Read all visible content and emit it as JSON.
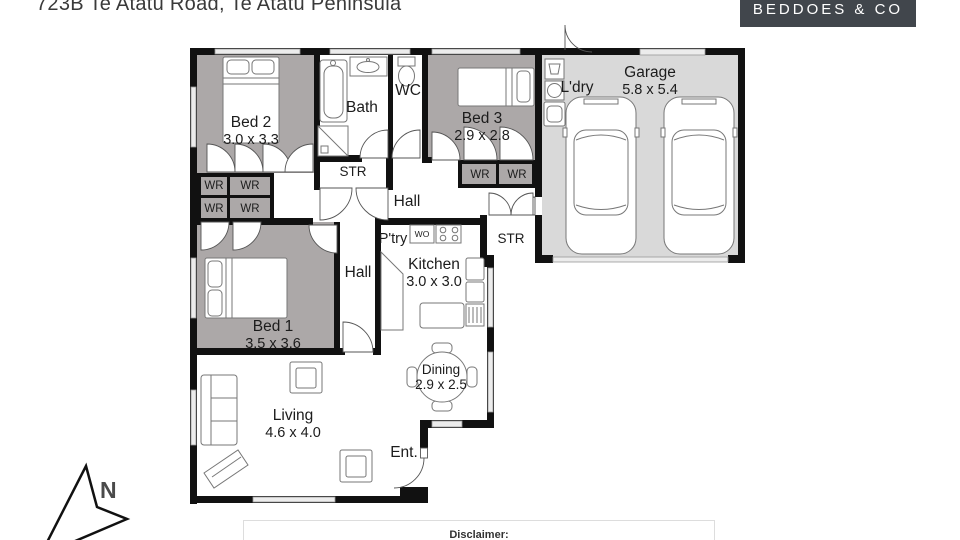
{
  "header": {
    "title": "723B Te Atatu Road, Te Atatu Peninsula",
    "brand": "BEDDOES & CO"
  },
  "floorplan": {
    "rooms": {
      "bed1": {
        "name": "Bed 1",
        "dims": "3.5 x 3.6"
      },
      "bed2": {
        "name": "Bed 2",
        "dims": "3.0 x 3.3"
      },
      "bed3": {
        "name": "Bed 3",
        "dims": "2.9 x 2.8"
      },
      "bath": {
        "name": "Bath"
      },
      "wc": {
        "name": "WC"
      },
      "laundry": {
        "name": "L'dry"
      },
      "garage": {
        "name": "Garage",
        "dims": "5.8 x 5.4"
      },
      "kitchen": {
        "name": "Kitchen",
        "dims": "3.0 x 3.0"
      },
      "pantry": {
        "name": "P'try"
      },
      "wall_oven": {
        "name": "WO"
      },
      "living": {
        "name": "Living",
        "dims": "4.6 x 4.0"
      },
      "dining": {
        "name": "Dining",
        "dims": "2.9 x 2.5"
      },
      "entry": {
        "name": "Ent."
      },
      "hall": {
        "name": "Hall"
      },
      "storage": {
        "name": "STR"
      },
      "wardrobe": {
        "name": "WR"
      }
    },
    "compass": {
      "north_label": "N"
    }
  },
  "footer": {
    "disclaimer_heading": "Disclaimer:"
  },
  "colors": {
    "wall": "#111111",
    "room_fill": "#aca8a8",
    "garage_fill": "#d9d9d9",
    "brand_bg": "#41464c"
  }
}
